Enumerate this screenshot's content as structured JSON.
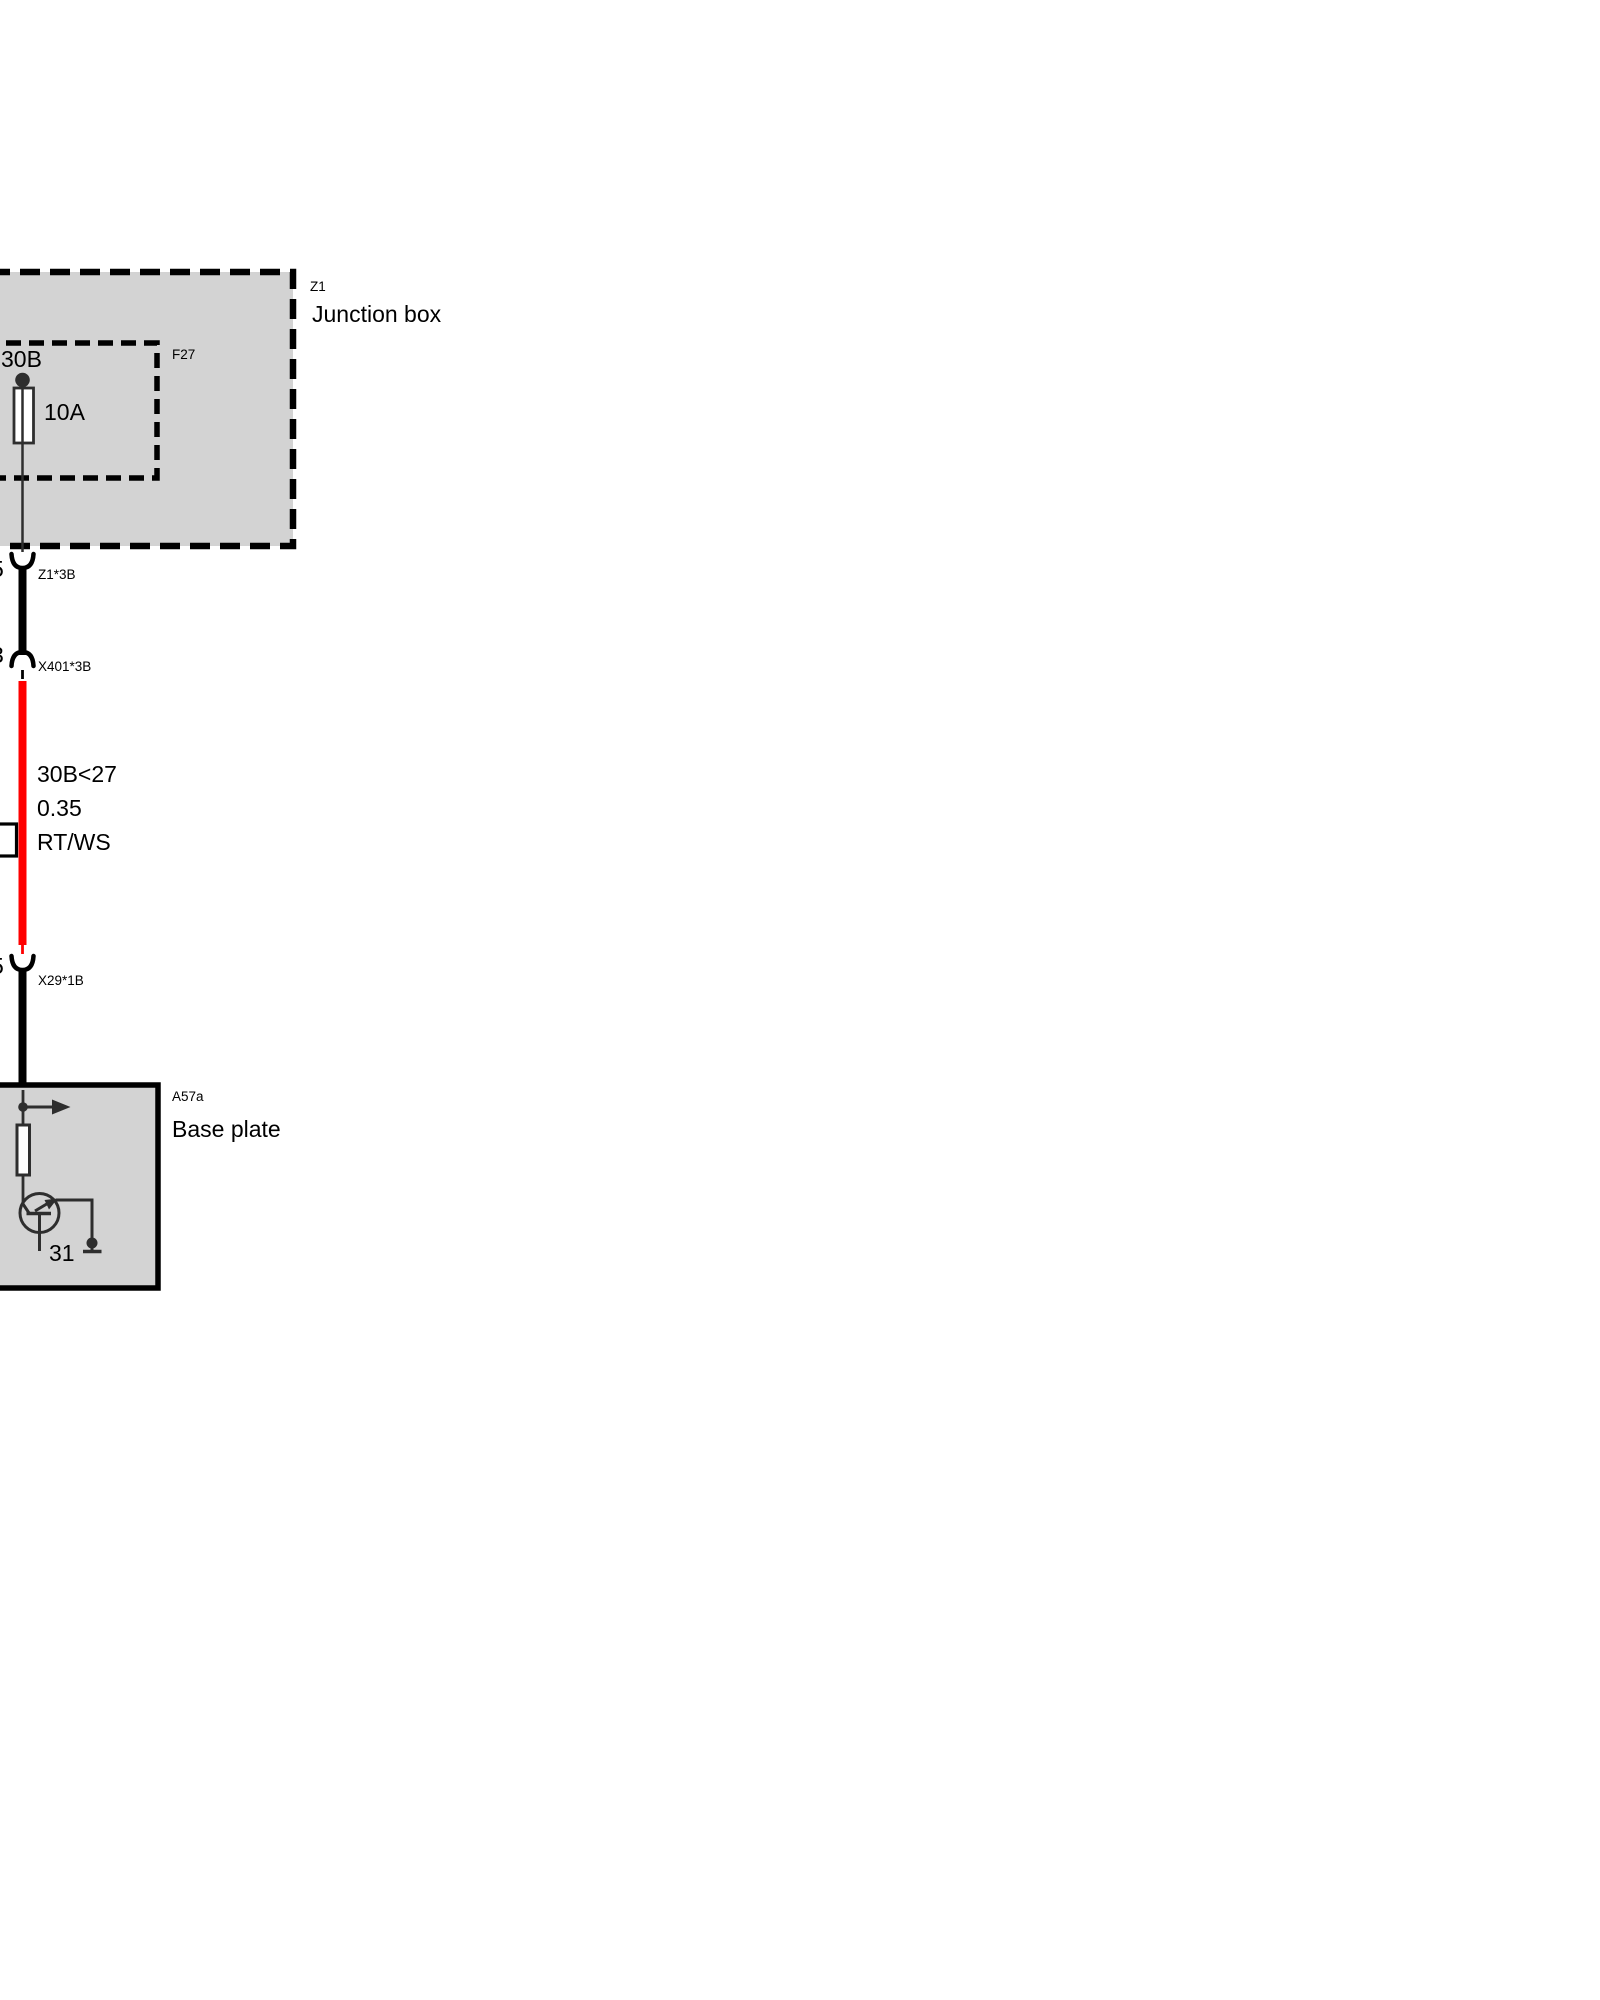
{
  "colors": {
    "page_bg": "#ffffff",
    "box_fill": "#d3d3d3",
    "outline": "#000000",
    "symbol_stroke": "#2e2e2e",
    "wire_red": "#ff0000",
    "wire_black": "#000000",
    "fuse_fill": "#ffffff"
  },
  "junction_box": {
    "code": "Z1",
    "label": "Junction box",
    "fuse": {
      "code": "F27",
      "terminal_label": "30B",
      "rating": "10A"
    }
  },
  "connectors": {
    "z1_3b": {
      "code": "Z1*3B",
      "pin": "5"
    },
    "x401_3b": {
      "code": "X401*3B",
      "pin": "3"
    },
    "x29_1b": {
      "code": "X29*1B",
      "pin": "5"
    }
  },
  "wire": {
    "circuit": "30B<27",
    "cross_section": "0.35",
    "color_code": "RT/WS"
  },
  "base_plate": {
    "code": "A57a",
    "label": "Base plate",
    "ground_terminal": "31"
  }
}
